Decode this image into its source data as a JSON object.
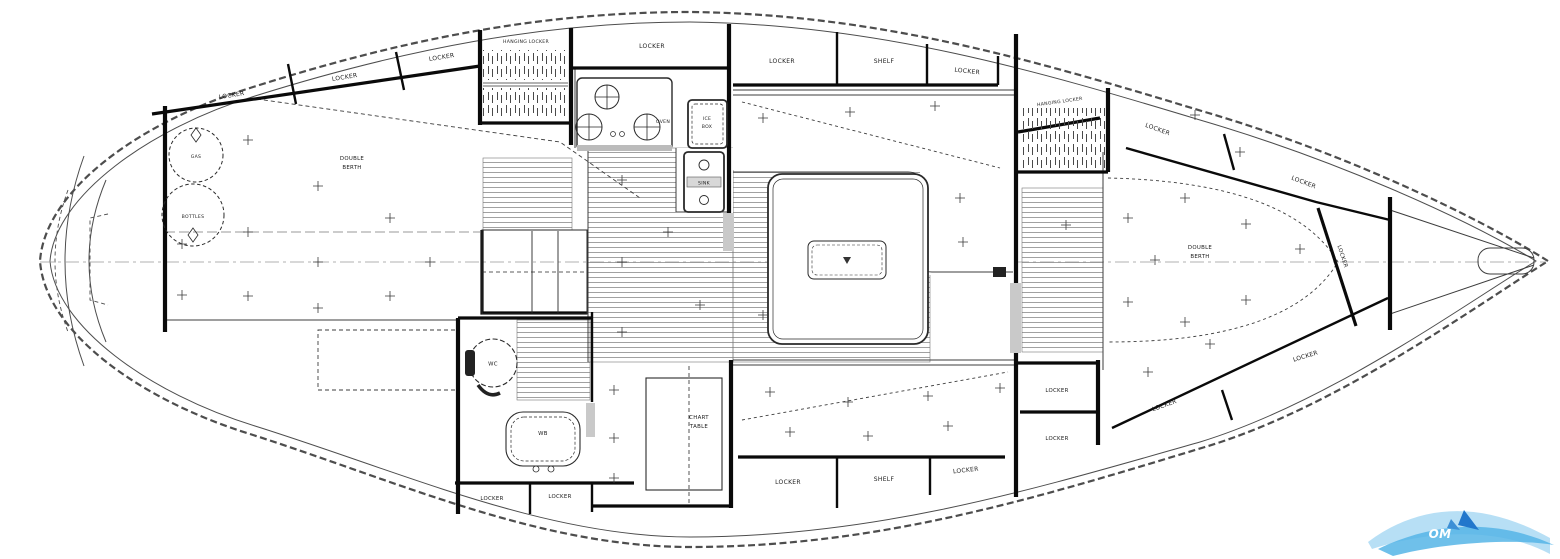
{
  "diagram": {
    "kind": "sailboat-interior-floor-plan",
    "colors": {
      "line": "#1c1c1c",
      "background": "#ffffff",
      "sole_hatch": "#888888",
      "door": "#c9c9c9",
      "wave_light": "#9fd4f2",
      "wave_dark": "#56b5e6"
    },
    "labels": {
      "aft_locker_1": "LOCKER",
      "aft_locker_2": "LOCKER",
      "aft_locker_3": "LOCKER",
      "hanging_locker_aft": "HANGING LOCKER",
      "galley_overhead_locker": "LOCKER",
      "gas": "GAS",
      "bottles": "BOTTLES",
      "aft_berth_1": "DOUBLE",
      "aft_berth_2": "BERTH",
      "oven": "OVEN",
      "icebox_1": "ICE",
      "icebox_2": "BOX",
      "sink": "SINK",
      "saloon_port_locker_1": "LOCKER",
      "saloon_port_shelf": "SHELF",
      "saloon_port_locker_2": "LOCKER",
      "head_wc": "WC",
      "head_basin": "WB",
      "head_locker_1": "LOCKER",
      "head_locker_2": "LOCKER",
      "chart_1": "CHART",
      "chart_2": "TABLE",
      "qtr_locker_1": "LOCKER",
      "qtr_shelf": "SHELF",
      "qtr_locker_2": "LOCKER",
      "stacked_locker_1": "LOCKER",
      "stacked_locker_2": "LOCKER",
      "hanging_locker_fwd": "HANGING LOCKER",
      "fwd_port_locker_1": "LOCKER",
      "fwd_port_locker_2": "LOCKER",
      "fwd_stbd_locker_1": "LOCKER",
      "fwd_stbd_locker_2": "LOCKER",
      "fwd_berth_1": "DOUBLE",
      "fwd_berth_2": "BERTH",
      "bow_locker": "LOCKER"
    },
    "watermark": {
      "text": "OM"
    }
  }
}
